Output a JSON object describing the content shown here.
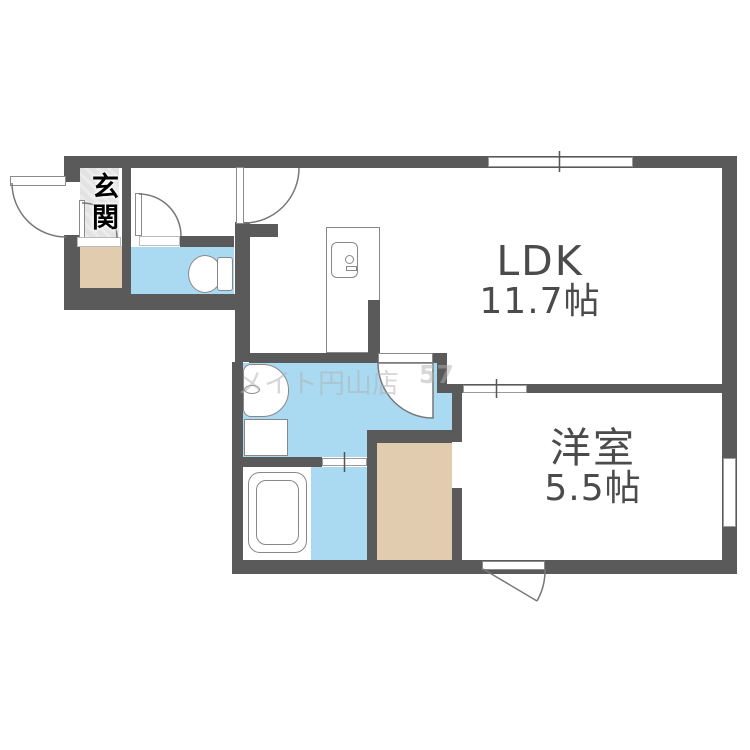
{
  "floorplan": {
    "rooms": {
      "ldk": {
        "label": "LDK",
        "area": "11.7帖"
      },
      "bedroom": {
        "label": "洋室",
        "area": "5.5帖"
      },
      "entrance": {
        "label": "玄関"
      }
    },
    "watermark": {
      "text_main": "メイト円山店",
      "text_number": "57"
    },
    "colors": {
      "wall": "#5a5a5a",
      "wet_area": "#a9daf2",
      "storage": "#e2ccb0",
      "entrance_tile": "#e4e4e4",
      "fixture_outline": "#888888",
      "label_text": "#4b4b4b"
    }
  }
}
